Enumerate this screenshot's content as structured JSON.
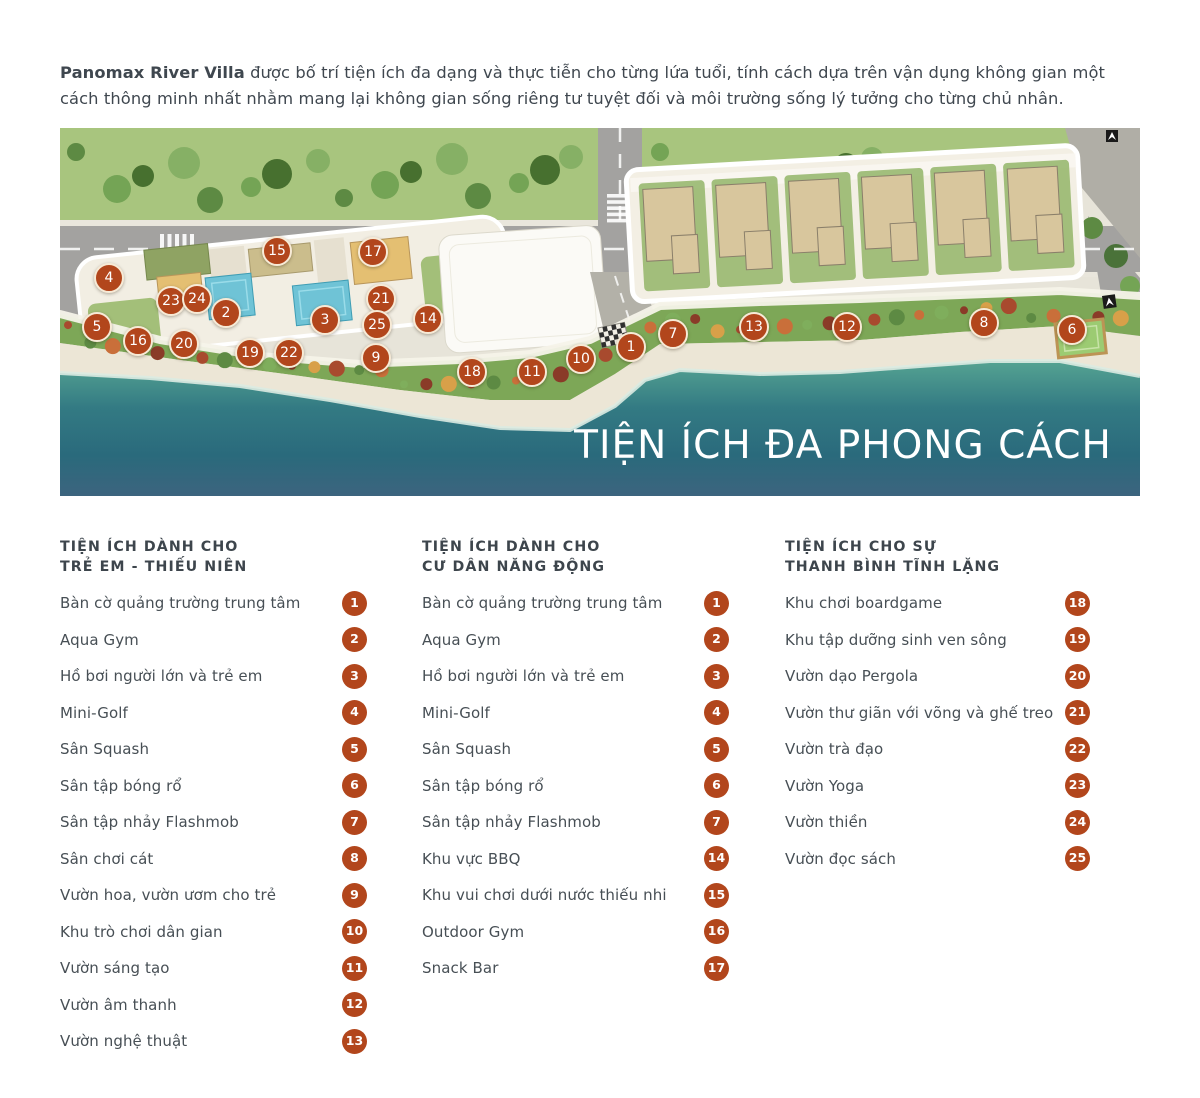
{
  "intro": {
    "lead": "Panomax River Villa",
    "text": " được bố trí tiện ích đa dạng và thực tiễn cho từng lứa tuổi, tính cách dựa trên vận dụng không gian một cách thông minh nhất nhằm mang lại không gian sống riêng tư tuyệt đối và môi trường sống lý tưởng cho từng chủ nhân."
  },
  "colors": {
    "accent_rust": "#b2461c",
    "water_teal": "#2e7080",
    "map_title_color": "#ffffff"
  },
  "map": {
    "overlay_title": "TIỆN ÍCH ĐA PHONG CÁCH",
    "markers": [
      {
        "n": 1,
        "x": 571,
        "y": 219
      },
      {
        "n": 2,
        "x": 166,
        "y": 185
      },
      {
        "n": 3,
        "x": 265,
        "y": 192
      },
      {
        "n": 4,
        "x": 49,
        "y": 150
      },
      {
        "n": 5,
        "x": 37,
        "y": 199
      },
      {
        "n": 6,
        "x": 1012,
        "y": 202
      },
      {
        "n": 7,
        "x": 613,
        "y": 206
      },
      {
        "n": 8,
        "x": 924,
        "y": 195
      },
      {
        "n": 9,
        "x": 316,
        "y": 230
      },
      {
        "n": 10,
        "x": 521,
        "y": 231
      },
      {
        "n": 11,
        "x": 472,
        "y": 244
      },
      {
        "n": 12,
        "x": 787,
        "y": 199
      },
      {
        "n": 13,
        "x": 694,
        "y": 199
      },
      {
        "n": 14,
        "x": 368,
        "y": 191
      },
      {
        "n": 15,
        "x": 217,
        "y": 123
      },
      {
        "n": 16,
        "x": 78,
        "y": 213
      },
      {
        "n": 17,
        "x": 313,
        "y": 124
      },
      {
        "n": 18,
        "x": 412,
        "y": 244
      },
      {
        "n": 19,
        "x": 190,
        "y": 225
      },
      {
        "n": 20,
        "x": 124,
        "y": 216
      },
      {
        "n": 21,
        "x": 321,
        "y": 171
      },
      {
        "n": 22,
        "x": 229,
        "y": 225
      },
      {
        "n": 23,
        "x": 111,
        "y": 173
      },
      {
        "n": 24,
        "x": 137,
        "y": 171
      },
      {
        "n": 25,
        "x": 317,
        "y": 197
      }
    ]
  },
  "legend": {
    "columns": [
      {
        "title_line1": "TIỆN ÍCH DÀNH CHO",
        "title_line2": "TRẺ EM - THIẾU NIÊN",
        "items": [
          {
            "num": 1,
            "label": "Bàn cờ quảng trường trung tâm"
          },
          {
            "num": 2,
            "label": "Aqua Gym"
          },
          {
            "num": 3,
            "label": "Hồ bơi người lớn và trẻ em"
          },
          {
            "num": 4,
            "label": "Mini-Golf"
          },
          {
            "num": 5,
            "label": "Sân Squash"
          },
          {
            "num": 6,
            "label": "Sân tập bóng rổ"
          },
          {
            "num": 7,
            "label": "Sân tập nhảy Flashmob"
          },
          {
            "num": 8,
            "label": "Sân chơi cát"
          },
          {
            "num": 9,
            "label": "Vườn hoa, vườn ươm cho trẻ"
          },
          {
            "num": 10,
            "label": "Khu trò chơi dân gian"
          },
          {
            "num": 11,
            "label": "Vườn sáng tạo"
          },
          {
            "num": 12,
            "label": "Vườn âm thanh"
          },
          {
            "num": 13,
            "label": "Vườn nghệ thuật"
          }
        ]
      },
      {
        "title_line1": "TIỆN ÍCH DÀNH CHO",
        "title_line2": "CƯ DÂN NĂNG ĐỘNG",
        "items": [
          {
            "num": 1,
            "label": "Bàn cờ quảng trường trung tâm"
          },
          {
            "num": 2,
            "label": "Aqua Gym"
          },
          {
            "num": 3,
            "label": "Hồ bơi người lớn và trẻ em"
          },
          {
            "num": 4,
            "label": "Mini-Golf"
          },
          {
            "num": 5,
            "label": "Sân Squash"
          },
          {
            "num": 6,
            "label": "Sân tập bóng rổ"
          },
          {
            "num": 7,
            "label": "Sân tập nhảy Flashmob"
          },
          {
            "num": 14,
            "label": "Khu vực BBQ"
          },
          {
            "num": 15,
            "label": "Khu vui chơi dưới nước thiếu nhi"
          },
          {
            "num": 16,
            "label": "Outdoor Gym"
          },
          {
            "num": 17,
            "label": "Snack Bar"
          }
        ]
      },
      {
        "title_line1": "TIỆN ÍCH CHO SỰ",
        "title_line2": "THANH BÌNH TĨNH LẶNG",
        "items": [
          {
            "num": 18,
            "label": "Khu chơi boardgame"
          },
          {
            "num": 19,
            "label": "Khu tập dưỡng sinh ven sông"
          },
          {
            "num": 20,
            "label": "Vườn dạo Pergola"
          },
          {
            "num": 21,
            "label": "Vườn thư giãn với võng và ghế treo"
          },
          {
            "num": 22,
            "label": "Vườn trà đạo"
          },
          {
            "num": 23,
            "label": "Vườn Yoga"
          },
          {
            "num": 24,
            "label": "Vườn thiền"
          },
          {
            "num": 25,
            "label": "Vườn đọc sách"
          }
        ]
      }
    ]
  }
}
